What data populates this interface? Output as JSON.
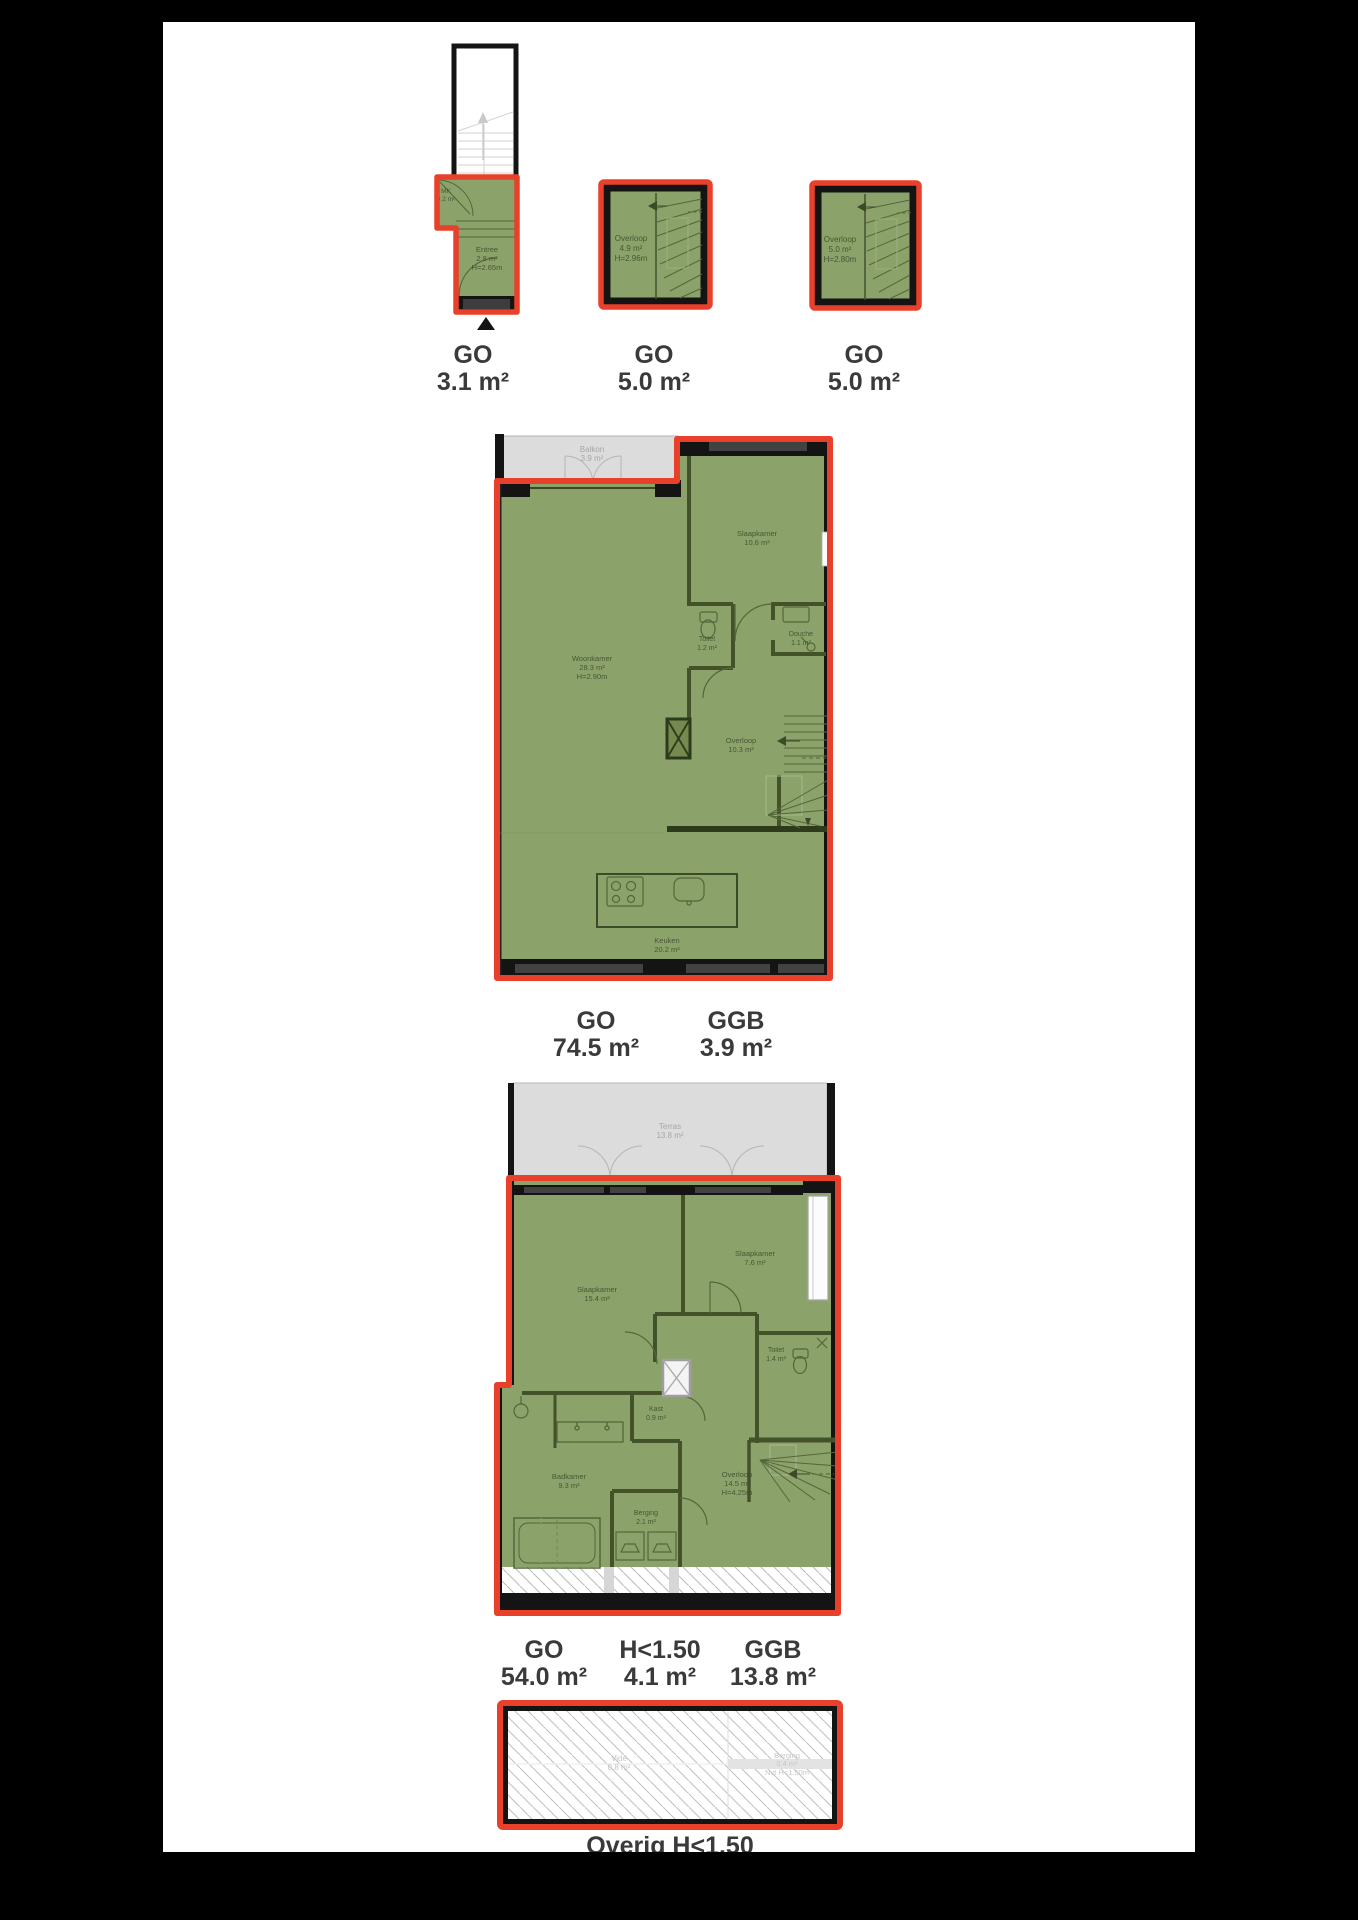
{
  "colors": {
    "accent_red": "#e8402a",
    "go_green": "#8ba36b",
    "outdoor_gray": "#dcdcdc",
    "wall_black": "#121212",
    "caption_text": "#3a3a3a"
  },
  "plans": {
    "entree": {
      "rooms": {
        "mk": {
          "name": "MK",
          "area": "0.2 m²"
        },
        "entree": {
          "name": "Entree",
          "area": "2.8 m²",
          "height": "H=2.65m"
        }
      },
      "caption": {
        "category": "GO",
        "area": "3.1 m²"
      }
    },
    "overloop1": {
      "rooms": {
        "overloop": {
          "name": "Overloop",
          "area": "4.9 m²",
          "height": "H=2.96m"
        }
      },
      "caption": {
        "category": "GO",
        "area": "5.0 m²"
      }
    },
    "overloop2": {
      "rooms": {
        "overloop": {
          "name": "Overloop",
          "area": "5.0 m²",
          "height": "H=2.80m"
        }
      },
      "caption": {
        "category": "GO",
        "area": "5.0 m²"
      }
    },
    "woonverdieping": {
      "rooms": {
        "balkon": {
          "name": "Balkon",
          "area": "3.9 m²"
        },
        "slaapkamer": {
          "name": "Slaapkamer",
          "area": "10.6 m²"
        },
        "toilet": {
          "name": "Toilet",
          "area": "1.2 m²"
        },
        "douche": {
          "name": "Douche",
          "area": "1.1 m²"
        },
        "woonkamer": {
          "name": "Woonkamer",
          "area": "28.3 m²",
          "height": "H=2.90m"
        },
        "overloop": {
          "name": "Overloop",
          "area": "10.3 m²"
        },
        "keuken": {
          "name": "Keuken",
          "area": "20.2 m²"
        }
      },
      "captions": {
        "go": {
          "category": "GO",
          "area": "74.5 m²"
        },
        "ggb": {
          "category": "GGB",
          "area": "3.9 m²"
        }
      }
    },
    "slaapverdieping": {
      "rooms": {
        "terras": {
          "name": "Terras",
          "area": "13.8 m²"
        },
        "slaapkamer1": {
          "name": "Slaapkamer",
          "area": "15.4 m²"
        },
        "slaapkamer2": {
          "name": "Slaapkamer",
          "area": "7.6 m²"
        },
        "toilet": {
          "name": "Toilet",
          "area": "1.4 m²"
        },
        "kast": {
          "name": "Kast",
          "area": "0.9 m²"
        },
        "badkamer": {
          "name": "Badkamer",
          "area": "9.3 m²"
        },
        "berging": {
          "name": "Berging",
          "area": "2.1 m²"
        },
        "overloop": {
          "name": "Overloop",
          "area": "14.5 m²",
          "height": "H=4.25m"
        }
      },
      "captions": {
        "go": {
          "category": "GO",
          "area": "54.0 m²"
        },
        "h150": {
          "category": "H<1.50",
          "area": "4.1 m²"
        },
        "ggb": {
          "category": "GGB",
          "area": "13.8 m²"
        }
      }
    },
    "vliering": {
      "rooms": {
        "vide": {
          "name": "Vide",
          "area": "0.8 m²"
        },
        "berging": {
          "name": "Berging",
          "area": "0.4 m²",
          "height": "Nvt H<1.50m"
        }
      },
      "caption_clipped": "Overig H<1.50"
    }
  }
}
